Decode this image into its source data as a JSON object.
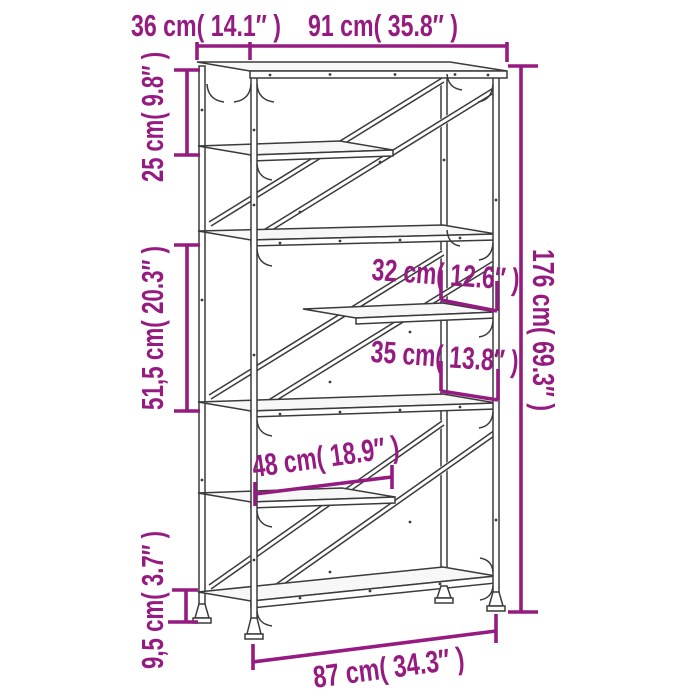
{
  "diagram": {
    "type": "furniture-dimension-diagram",
    "item": "5-tier industrial bookshelf with diagonal steel braces",
    "accent_color": "#951B81",
    "line_color": "#3b3b3b",
    "labels": {
      "depth": "36 cm( 14.1″ )",
      "top_width": "91 cm( 35.8″ )",
      "total_height": "176 cm( 69.3″ )",
      "upper_section_height": "25 cm( 9.8″ )",
      "middle_section_height": "51,5 cm( 20.3″ )",
      "ground_clearance": "9,5 cm( 3.7″ )",
      "compartment_upper": "32 cm( 12.6″ )",
      "compartment_lower": "35 cm( 13.8″ )",
      "half_shelf_width": "48 cm( 18.9″ )",
      "base_width": "87 cm( 34.3″ )"
    },
    "values": {
      "depth_cm": "36",
      "depth_in": "14.1",
      "top_width_cm": "91",
      "top_width_in": "35.8",
      "total_height_cm": "176",
      "total_height_in": "69.3",
      "upper_section_cm": "25",
      "upper_section_in": "9.8",
      "middle_section_cm": "51,5",
      "middle_section_in": "20.3",
      "ground_clearance_cm": "9,5",
      "ground_clearance_in": "3.7",
      "compartment_upper_cm": "32",
      "compartment_upper_in": "12.6",
      "compartment_lower_cm": "35",
      "compartment_lower_in": "13.8",
      "half_shelf_cm": "48",
      "half_shelf_in": "18.9",
      "base_width_cm": "87",
      "base_width_in": "34.3"
    }
  }
}
